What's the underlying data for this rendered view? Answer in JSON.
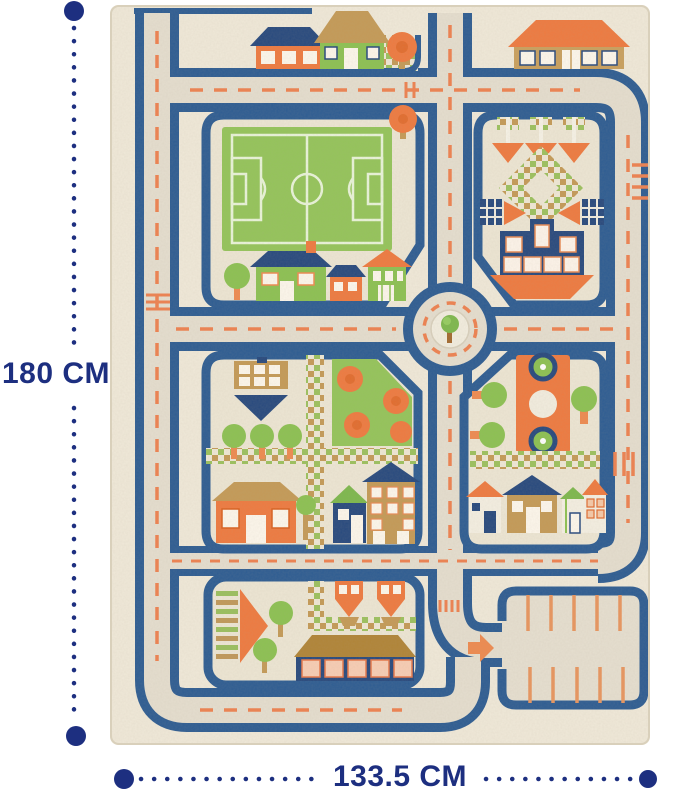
{
  "image": {
    "subject": "kids city traffic play rug, top view product photo"
  },
  "annotations": {
    "height_label": "180 CM",
    "width_label": "133.5 CM"
  },
  "palette": {
    "annotation_navy": "#1d2f80",
    "rug_cream": "#f0e9d9",
    "road_navy": "#2d5c92",
    "road_surface": "#e5decf",
    "marking_orange": "#ee7a40",
    "grass_green": "#93c45b",
    "roof_tan": "#c49a57"
  }
}
